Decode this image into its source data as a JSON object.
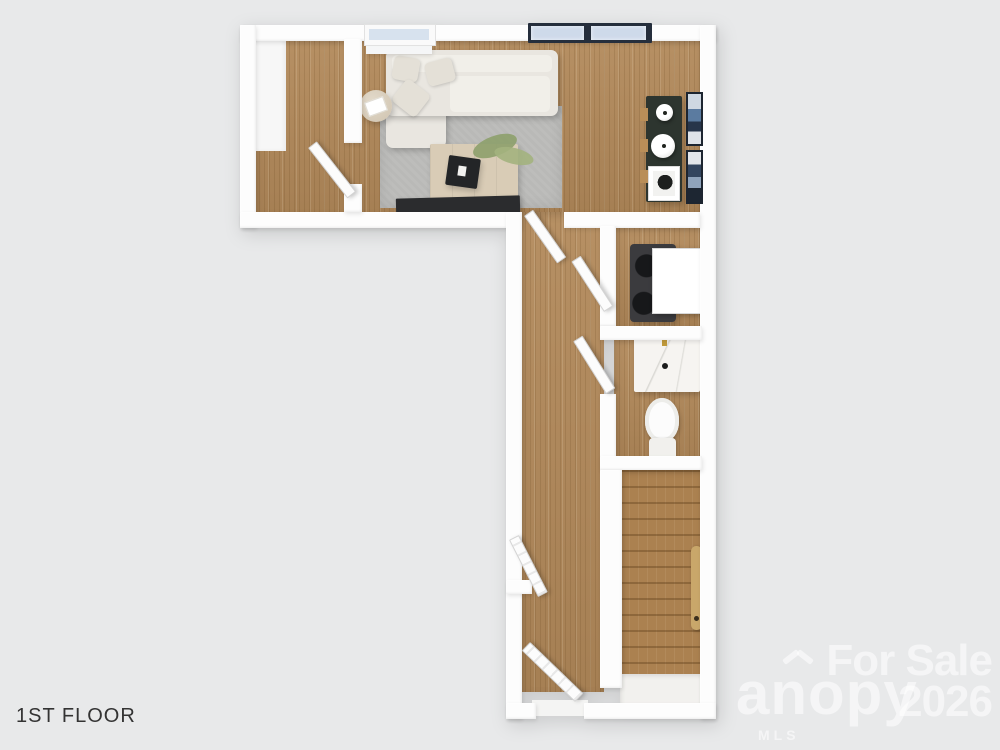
{
  "floor": {
    "label": "1ST FLOOR"
  },
  "watermark": {
    "sale_line1": "For Sale",
    "sale_line2": "2026",
    "logo_text": "anopy",
    "logo_sub": "MLS"
  },
  "palette": {
    "background": "#e8e9ea",
    "wall_white": "#fdfdfd",
    "wood_floor": "#b2895a",
    "stair_wood": "#ab8150",
    "rug_gray": "#b9b9b7",
    "sofa_cream": "#e9e6e0",
    "console_dark_green": "#2d352f",
    "tv_black": "#2b2c2e",
    "glass_blue": "#cedaea",
    "door_frame_dark": "#252e3c",
    "faucet_gold": "#c19a3b",
    "handrail_tan": "#c9a76a",
    "label_color": "#333333",
    "watermark_color": "rgba(255,255,255,0.55)"
  }
}
